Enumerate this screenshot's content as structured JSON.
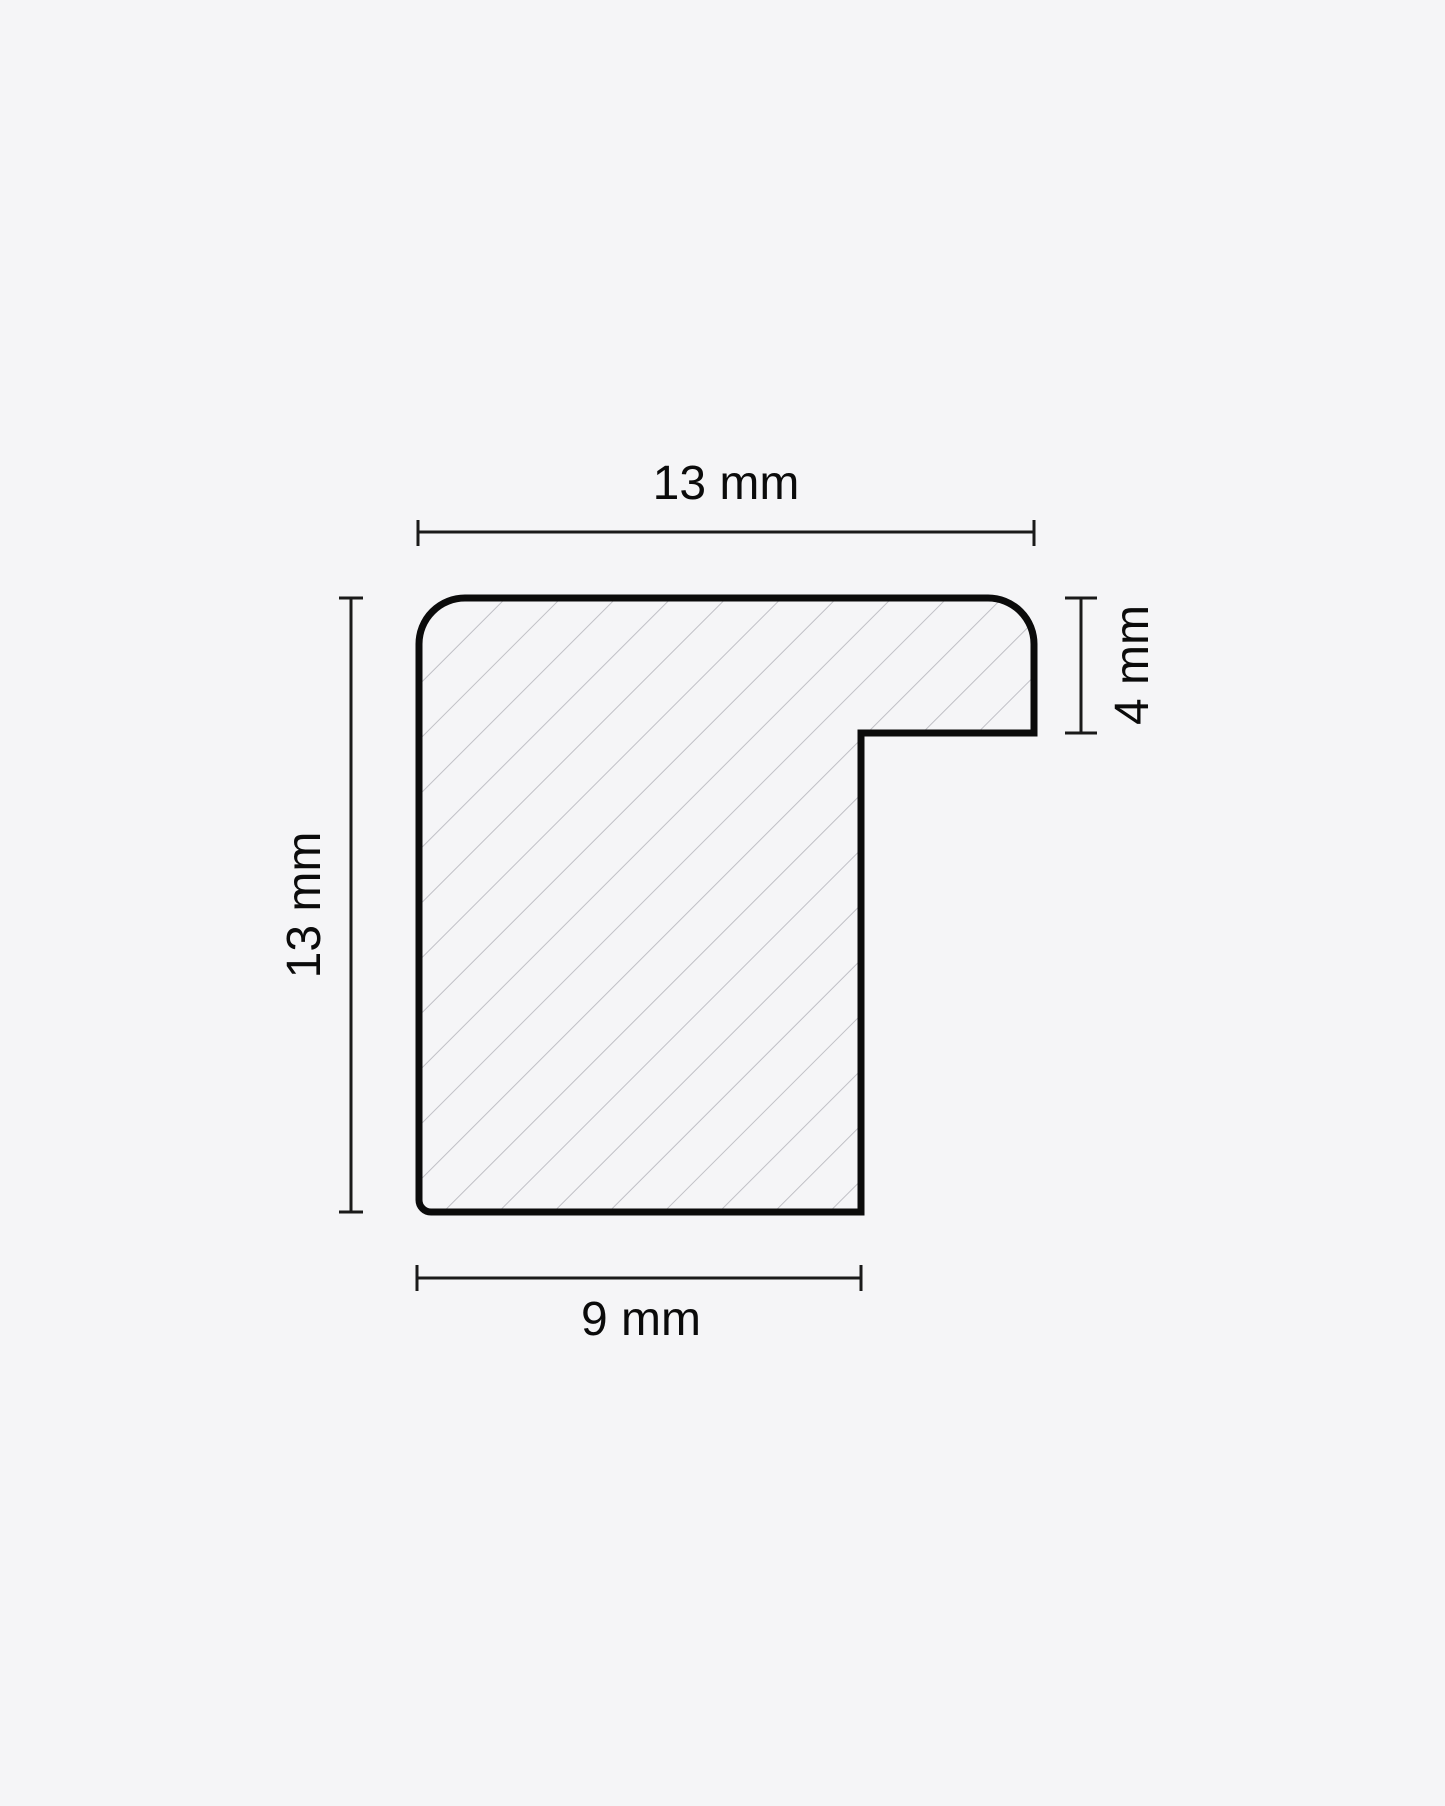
{
  "diagram": {
    "kind": "moulding-profile-cross-section",
    "dimensions": {
      "top_width": {
        "label": "13 mm",
        "value_mm": 13,
        "orientation": "horizontal"
      },
      "left_height": {
        "label": "13 mm",
        "value_mm": 13,
        "orientation": "vertical"
      },
      "rabbet_depth": {
        "label": "4 mm",
        "value_mm": 4,
        "orientation": "vertical"
      },
      "bottom_width": {
        "label": "9 mm",
        "value_mm": 9,
        "orientation": "horizontal"
      }
    },
    "colors": {
      "background": "#f5f5f7",
      "outline": "#0b0b0b",
      "hatch": "#c0c0c6",
      "dimension_lines": "#1a1a1a",
      "text": "#0b0b0b"
    }
  }
}
